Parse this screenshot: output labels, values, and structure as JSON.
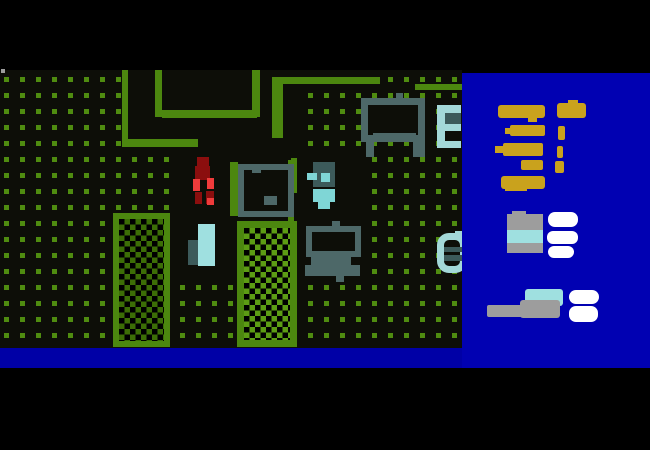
{
  "window": {
    "width": 650,
    "height": 450,
    "description": "top-down pixel game scene with inventory sidebar"
  },
  "colors": {
    "field_bg": "#0d0e08",
    "dot_green": "#4f8c10",
    "wall_green": "#4c870f",
    "hatch_dark": "#3c6e06",
    "hatch_bright": "#5c9c14",
    "furniture_gray": "#4d6868",
    "teal_dark": "#3c5a5a",
    "cyan_pale": "#a3d8d8",
    "cyan_light": "#9fe0e0",
    "toilet_cyan": "#7fd6d6",
    "blood_dark": "#8b0e0e",
    "blood_bright": "#ef3b3b",
    "sidebar_blue": "#0101b2",
    "bar_blue": "#0000a6",
    "gold": "#c9a21d",
    "item_gray": "#9d9d9d",
    "item_white": "#ffffff"
  },
  "layout": {
    "field": {
      "x": 0,
      "y": 70,
      "w": 462,
      "h": 278
    },
    "sidebar": {
      "x": 462,
      "y": 73,
      "w": 188,
      "h": 295
    },
    "status_bar": {
      "x": 0,
      "y": 348,
      "w": 650,
      "h": 20
    },
    "dot_grid": {
      "dot_size": 5,
      "spacing": 16,
      "offset_x": 4,
      "offset_y": 7
    }
  },
  "world": [
    {
      "name": "room-floor-a",
      "interactable": false,
      "x": 122,
      "y": 70,
      "w": 175,
      "h": 77,
      "fill": "field_bg"
    },
    {
      "name": "room-floor-b",
      "interactable": false,
      "x": 180,
      "y": 147,
      "w": 115,
      "h": 75,
      "fill": "field_bg"
    },
    {
      "name": "room-floor-c",
      "interactable": false,
      "x": 295,
      "y": 147,
      "w": 67,
      "h": 135,
      "fill": "field_bg"
    },
    {
      "name": "room-floor-d",
      "interactable": false,
      "x": 180,
      "y": 222,
      "w": 58,
      "h": 58,
      "fill": "field_bg"
    },
    {
      "name": "bunk-gap",
      "interactable": false,
      "x": 445,
      "y": 131,
      "w": 16,
      "h": 10,
      "fill": "field_bg"
    },
    {
      "name": "wall-segment-1",
      "interactable": false,
      "x": 122,
      "y": 70,
      "w": 6,
      "h": 77,
      "fill": "wall_green"
    },
    {
      "name": "wall-segment-2",
      "interactable": false,
      "x": 128,
      "y": 139,
      "w": 70,
      "h": 8,
      "fill": "wall_green"
    },
    {
      "name": "wall-segment-3",
      "interactable": false,
      "x": 155,
      "y": 70,
      "w": 7,
      "h": 47,
      "fill": "wall_green"
    },
    {
      "name": "wall-segment-4",
      "interactable": false,
      "x": 162,
      "y": 110,
      "w": 95,
      "h": 8,
      "fill": "wall_green"
    },
    {
      "name": "wall-segment-5",
      "interactable": false,
      "x": 252,
      "y": 70,
      "w": 8,
      "h": 47,
      "fill": "wall_green"
    },
    {
      "name": "wall-segment-6",
      "interactable": false,
      "x": 272,
      "y": 77,
      "w": 11,
      "h": 61,
      "fill": "wall_green"
    },
    {
      "name": "wall-segment-7",
      "interactable": false,
      "x": 272,
      "y": 77,
      "w": 108,
      "h": 7,
      "fill": "wall_green"
    },
    {
      "name": "wall-segment-8",
      "interactable": false,
      "x": 415,
      "y": 84,
      "w": 47,
      "h": 6,
      "fill": "wall_green"
    },
    {
      "name": "wall-segment-9",
      "interactable": false,
      "x": 291,
      "y": 158,
      "w": 6,
      "h": 17,
      "fill": "wall_green"
    },
    {
      "name": "wall-segment-10",
      "interactable": false,
      "x": 288,
      "y": 215,
      "w": 6,
      "h": 6,
      "fill": "wall_green"
    },
    {
      "name": "screen-artifact",
      "interactable": false,
      "x": 1,
      "y": 69,
      "w": 4,
      "h": 4,
      "fill": "item_gray"
    },
    {
      "name": "garden-bed-1",
      "interactable": false,
      "x": 113,
      "y": 213,
      "w": 57,
      "h": 134,
      "cls": "hatch-dark",
      "bd": {
        "w": 6,
        "c": "wall_green"
      }
    },
    {
      "name": "garden-bed-2",
      "interactable": false,
      "x": 237,
      "y": 221,
      "w": 60,
      "h": 126,
      "cls": "hatch-bright",
      "bd": {
        "w": 7,
        "c": "wall_green"
      }
    },
    {
      "name": "table-frame",
      "interactable": false,
      "x": 361,
      "y": 98,
      "w": 64,
      "h": 44,
      "fill": "field_bg",
      "bd": {
        "w": 7,
        "c": "furniture_gray"
      }
    },
    {
      "name": "table-knob",
      "interactable": false,
      "x": 396,
      "y": 93,
      "w": 7,
      "h": 6,
      "fill": "furniture_gray"
    },
    {
      "name": "table-shelf",
      "interactable": false,
      "x": 373,
      "y": 133,
      "w": 43,
      "h": 9,
      "fill": "furniture_gray"
    },
    {
      "name": "table-leg-left",
      "interactable": false,
      "x": 366,
      "y": 142,
      "w": 8,
      "h": 15,
      "fill": "furniture_gray"
    },
    {
      "name": "table-leg-right",
      "interactable": false,
      "x": 413,
      "y": 140,
      "w": 12,
      "h": 17,
      "fill": "furniture_gray"
    },
    {
      "name": "bunk-rail",
      "interactable": false,
      "x": 437,
      "y": 105,
      "w": 8,
      "h": 43,
      "fill": "cyan_pale"
    },
    {
      "name": "bunk-arm-top",
      "interactable": false,
      "x": 445,
      "y": 105,
      "w": 16,
      "h": 8,
      "fill": "cyan_pale"
    },
    {
      "name": "bunk-mattress",
      "interactable": false,
      "x": 445,
      "y": 113,
      "w": 16,
      "h": 11,
      "fill": "teal_dark"
    },
    {
      "name": "bunk-arm-mid",
      "interactable": false,
      "x": 445,
      "y": 124,
      "w": 16,
      "h": 7,
      "fill": "cyan_pale"
    },
    {
      "name": "bunk-arm-bottom",
      "interactable": false,
      "x": 445,
      "y": 141,
      "w": 16,
      "h": 7,
      "fill": "cyan_pale"
    },
    {
      "name": "toilet-tank",
      "interactable": false,
      "x": 313,
      "y": 162,
      "w": 22,
      "h": 25,
      "fill": "teal_dark"
    },
    {
      "name": "toilet-flush-left",
      "interactable": false,
      "x": 307,
      "y": 173,
      "w": 10,
      "h": 7,
      "fill": "toilet_cyan"
    },
    {
      "name": "toilet-flush-right",
      "interactable": false,
      "x": 321,
      "y": 173,
      "w": 9,
      "h": 9,
      "fill": "toilet_cyan"
    },
    {
      "name": "toilet-bowl",
      "interactable": false,
      "x": 313,
      "y": 189,
      "w": 22,
      "h": 13,
      "fill": "toilet_cyan"
    },
    {
      "name": "toilet-seat",
      "interactable": false,
      "x": 318,
      "y": 202,
      "w": 12,
      "h": 7,
      "fill": "toilet_cyan"
    },
    {
      "name": "player-head",
      "interactable": false,
      "x": 197,
      "y": 157,
      "w": 12,
      "h": 11,
      "fill": "blood_dark"
    },
    {
      "name": "player-torso",
      "interactable": false,
      "x": 195,
      "y": 166,
      "w": 15,
      "h": 14,
      "fill": "blood_dark"
    },
    {
      "name": "player-arm-left",
      "interactable": false,
      "x": 193,
      "y": 179,
      "w": 7,
      "h": 12,
      "fill": "blood_bright"
    },
    {
      "name": "player-arm-right",
      "interactable": false,
      "x": 207,
      "y": 178,
      "w": 7,
      "h": 11,
      "fill": "blood_bright"
    },
    {
      "name": "player-leg-left",
      "interactable": false,
      "x": 195,
      "y": 192,
      "w": 7,
      "h": 12,
      "fill": "blood_dark"
    },
    {
      "name": "player-leg-right",
      "interactable": false,
      "x": 206,
      "y": 191,
      "w": 8,
      "h": 13,
      "fill": "blood_dark"
    },
    {
      "name": "player-foot",
      "interactable": false,
      "x": 207,
      "y": 198,
      "w": 7,
      "h": 7,
      "fill": "blood_bright"
    },
    {
      "name": "bed-rail-left",
      "interactable": false,
      "x": 230,
      "y": 162,
      "w": 8,
      "h": 54,
      "fill": "wall_green"
    },
    {
      "name": "bed-rail-right",
      "interactable": false,
      "x": 288,
      "y": 160,
      "w": 9,
      "h": 33,
      "fill": "wall_green"
    },
    {
      "name": "bed-frame",
      "interactable": false,
      "x": 238,
      "y": 164,
      "w": 56,
      "h": 53,
      "fill": "field_bg",
      "bd": {
        "w": 6,
        "c": "furniture_gray"
      }
    },
    {
      "name": "bed-notch",
      "interactable": false,
      "x": 252,
      "y": 164,
      "w": 9,
      "h": 9,
      "fill": "furniture_gray"
    },
    {
      "name": "bed-pillow",
      "interactable": false,
      "x": 264,
      "y": 196,
      "w": 13,
      "h": 9,
      "fill": "furniture_gray"
    },
    {
      "name": "fridge-body",
      "interactable": false,
      "x": 198,
      "y": 224,
      "w": 17,
      "h": 42,
      "fill": "cyan_light"
    },
    {
      "name": "fridge-side",
      "interactable": false,
      "x": 188,
      "y": 240,
      "w": 10,
      "h": 25,
      "fill": "teal_dark"
    },
    {
      "name": "computer-screen",
      "interactable": false,
      "x": 306,
      "y": 226,
      "w": 55,
      "h": 31,
      "fill": "field_bg",
      "bd": {
        "w": 6,
        "c": "furniture_gray"
      }
    },
    {
      "name": "computer-antenna",
      "interactable": false,
      "x": 332,
      "y": 221,
      "w": 8,
      "h": 6,
      "fill": "furniture_gray"
    },
    {
      "name": "computer-keyboard",
      "interactable": false,
      "x": 311,
      "y": 257,
      "w": 40,
      "h": 8,
      "fill": "furniture_gray"
    },
    {
      "name": "computer-base",
      "interactable": false,
      "x": 305,
      "y": 265,
      "w": 55,
      "h": 11,
      "fill": "furniture_gray"
    },
    {
      "name": "computer-stand",
      "interactable": false,
      "x": 336,
      "y": 276,
      "w": 8,
      "h": 6,
      "fill": "furniture_gray"
    },
    {
      "name": "chair-ring",
      "interactable": false,
      "x": 437,
      "y": 233,
      "w": 30,
      "h": 40,
      "fill": "field_bg",
      "bd": {
        "w": 7,
        "c": "cyan_pale"
      },
      "r": 12
    },
    {
      "name": "chair-stub",
      "interactable": false,
      "x": 455,
      "y": 231,
      "w": 7,
      "h": 8,
      "fill": "cyan_pale"
    },
    {
      "name": "chair-slat-1",
      "interactable": false,
      "x": 444,
      "y": 247,
      "w": 18,
      "h": 5,
      "fill": "teal_dark"
    },
    {
      "name": "chair-slat-2",
      "interactable": false,
      "x": 444,
      "y": 255,
      "w": 18,
      "h": 6,
      "fill": "teal_dark"
    }
  ],
  "inventory": [
    {
      "name": "gold-weapon-icon-1",
      "interactable": true,
      "x": 36,
      "y": 32,
      "w": 47,
      "h": 13,
      "fill": "gold",
      "r": 3
    },
    {
      "name": "gold-weapon-icon-1-grip",
      "interactable": true,
      "x": 66,
      "y": 44,
      "w": 9,
      "h": 5,
      "fill": "gold"
    },
    {
      "name": "gold-weapon-icon-2",
      "interactable": true,
      "x": 95,
      "y": 30,
      "w": 29,
      "h": 15,
      "fill": "gold",
      "r": 3
    },
    {
      "name": "gold-weapon-icon-2-sight",
      "interactable": true,
      "x": 106,
      "y": 27,
      "w": 10,
      "h": 5,
      "fill": "gold"
    },
    {
      "name": "gold-weapon-icon-3",
      "interactable": true,
      "x": 48,
      "y": 52,
      "w": 35,
      "h": 11,
      "fill": "gold",
      "r": 2
    },
    {
      "name": "gold-weapon-icon-3-tip",
      "interactable": true,
      "x": 43,
      "y": 55,
      "w": 7,
      "h": 6,
      "fill": "gold"
    },
    {
      "name": "gold-clip-icon-1",
      "interactable": true,
      "x": 96,
      "y": 53,
      "w": 7,
      "h": 14,
      "fill": "gold",
      "r": 2
    },
    {
      "name": "gold-weapon-icon-4",
      "interactable": true,
      "x": 41,
      "y": 70,
      "w": 40,
      "h": 13,
      "fill": "gold",
      "r": 2
    },
    {
      "name": "gold-weapon-icon-4-tip",
      "interactable": true,
      "x": 33,
      "y": 73,
      "w": 10,
      "h": 7,
      "fill": "gold"
    },
    {
      "name": "gold-clip-icon-2",
      "interactable": true,
      "x": 95,
      "y": 73,
      "w": 6,
      "h": 12,
      "fill": "gold",
      "r": 2
    },
    {
      "name": "gold-weapon-icon-5",
      "interactable": true,
      "x": 59,
      "y": 87,
      "w": 22,
      "h": 10,
      "fill": "gold",
      "r": 2
    },
    {
      "name": "gold-clip-icon-3",
      "interactable": true,
      "x": 93,
      "y": 88,
      "w": 9,
      "h": 12,
      "fill": "gold",
      "r": 2
    },
    {
      "name": "gold-weapon-icon-6",
      "interactable": true,
      "x": 39,
      "y": 103,
      "w": 44,
      "h": 13,
      "fill": "gold",
      "r": 3
    },
    {
      "name": "gold-weapon-icon-6-grip",
      "interactable": true,
      "x": 43,
      "y": 114,
      "w": 22,
      "h": 4,
      "fill": "gold"
    },
    {
      "name": "medkit-icon",
      "interactable": true,
      "x": 45,
      "y": 141,
      "w": 36,
      "h": 39,
      "fill": "item_gray"
    },
    {
      "name": "medkit-icon-lid",
      "interactable": true,
      "x": 50,
      "y": 138,
      "w": 14,
      "h": 4,
      "fill": "item_gray"
    },
    {
      "name": "medkit-icon-band",
      "interactable": true,
      "x": 45,
      "y": 157,
      "w": 36,
      "h": 13,
      "fill": "cyan_light"
    },
    {
      "name": "ammo-pack-icon-1",
      "interactable": true,
      "x": 86,
      "y": 139,
      "w": 30,
      "h": 15,
      "fill": "item_white",
      "r": 7
    },
    {
      "name": "ammo-pack-icon-2",
      "interactable": true,
      "x": 85,
      "y": 158,
      "w": 31,
      "h": 13,
      "fill": "item_white",
      "r": 6
    },
    {
      "name": "ammo-pack-icon-3",
      "interactable": true,
      "x": 86,
      "y": 173,
      "w": 26,
      "h": 12,
      "fill": "item_white",
      "r": 6
    },
    {
      "name": "device-icon",
      "interactable": true,
      "x": 63,
      "y": 216,
      "w": 38,
      "h": 17,
      "fill": "cyan_light",
      "r": 3
    },
    {
      "name": "tool-icon-handle",
      "interactable": true,
      "x": 25,
      "y": 232,
      "w": 60,
      "h": 12,
      "fill": "item_gray",
      "r": 2
    },
    {
      "name": "tool-icon-head",
      "interactable": true,
      "x": 58,
      "y": 227,
      "w": 40,
      "h": 18,
      "fill": "item_gray",
      "r": 3
    },
    {
      "name": "ammo-pack-icon-4",
      "interactable": true,
      "x": 107,
      "y": 217,
      "w": 30,
      "h": 14,
      "fill": "item_white",
      "r": 7
    },
    {
      "name": "ammo-pack-icon-5",
      "interactable": true,
      "x": 107,
      "y": 233,
      "w": 29,
      "h": 16,
      "fill": "item_white",
      "r": 7
    }
  ]
}
